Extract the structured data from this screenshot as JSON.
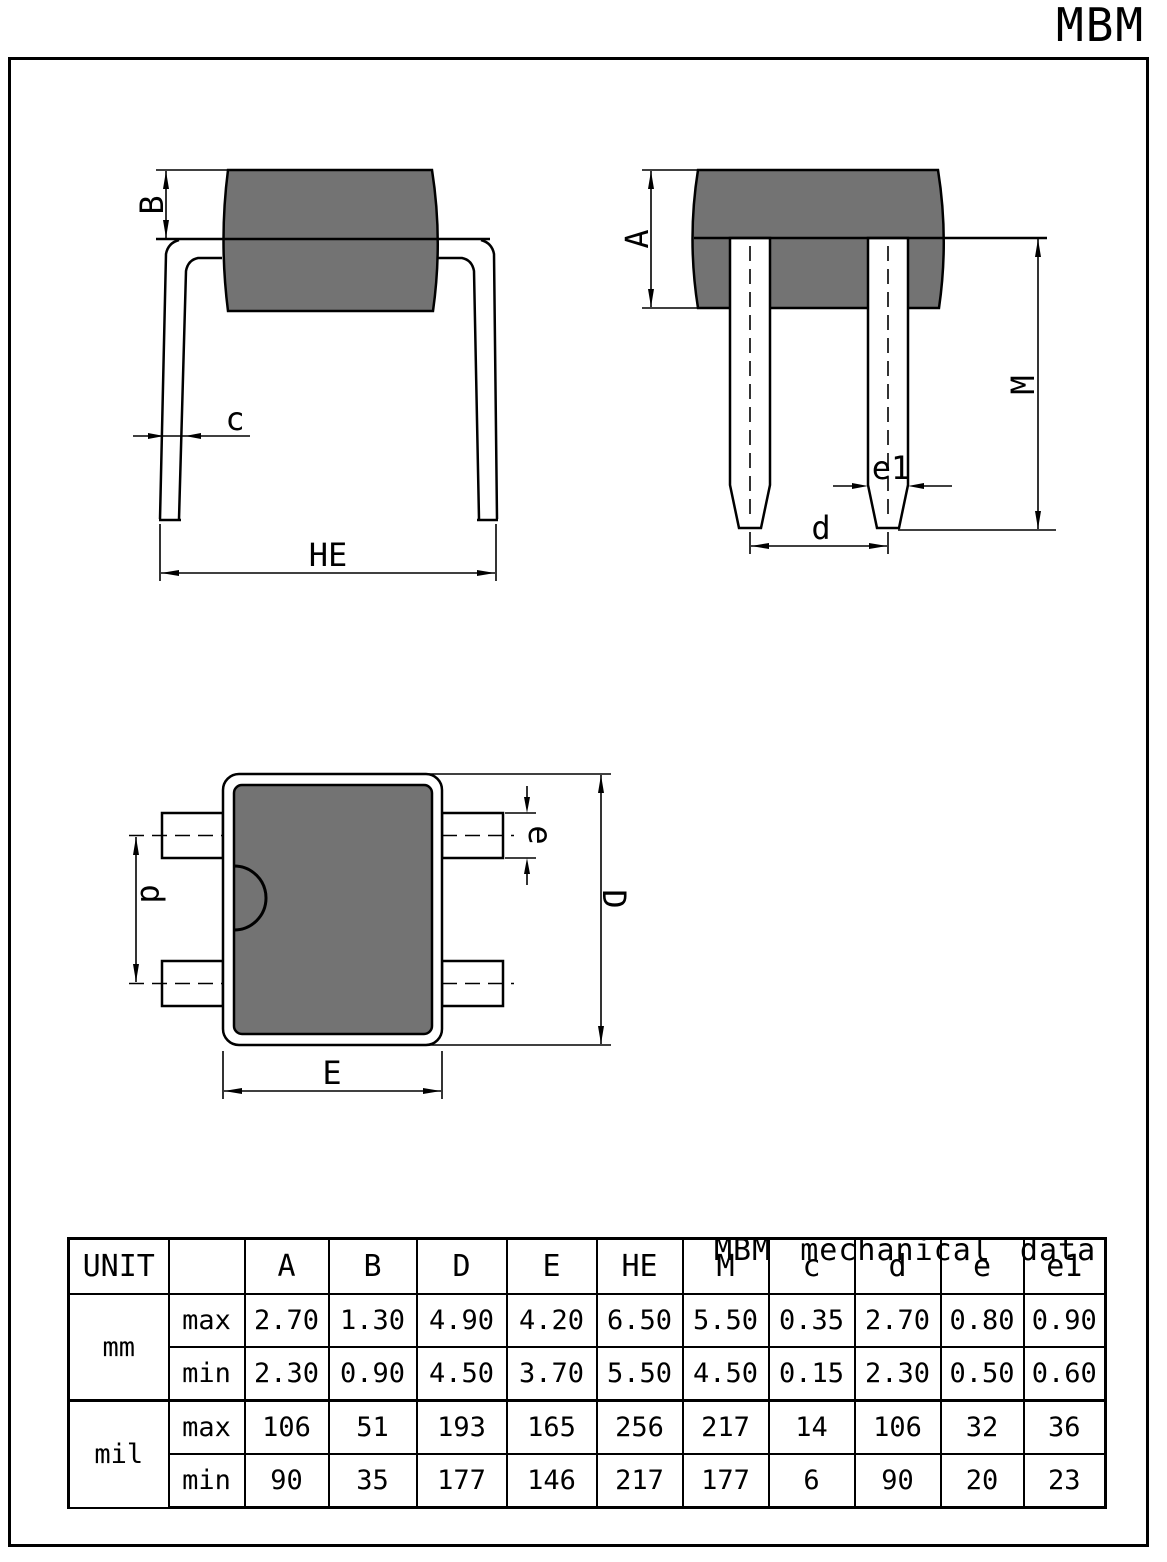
{
  "page": {
    "title": "MBM",
    "bg": "#ffffff",
    "line_color": "#000000",
    "body_gray": "#737373"
  },
  "views": {
    "front": {
      "dims": {
        "B": "B",
        "c": "c",
        "HE": "HE"
      }
    },
    "side": {
      "dims": {
        "A": "A",
        "M": "M",
        "e1": "e1",
        "d": "d"
      }
    },
    "plan": {
      "dims": {
        "d": "d",
        "e": "e",
        "D": "D",
        "E": "E"
      }
    }
  },
  "table": {
    "title": "MBM mechanical data",
    "unit_header": "UNIT",
    "dim_headers": [
      "A",
      "B",
      "D",
      "E",
      "HE",
      "M",
      "c",
      "d",
      "e",
      "e1"
    ],
    "rows": [
      {
        "unit": "mm",
        "bound": "max",
        "values": [
          "2.70",
          "1.30",
          "4.90",
          "4.20",
          "6.50",
          "5.50",
          "0.35",
          "2.70",
          "0.80",
          "0.90"
        ]
      },
      {
        "unit": "",
        "bound": "min",
        "values": [
          "2.30",
          "0.90",
          "4.50",
          "3.70",
          "5.50",
          "4.50",
          "0.15",
          "2.30",
          "0.50",
          "0.60"
        ]
      },
      {
        "unit": "mil",
        "bound": "max",
        "values": [
          "106",
          "51",
          "193",
          "165",
          "256",
          "217",
          "14",
          "106",
          "32",
          "36"
        ]
      },
      {
        "unit": "",
        "bound": "min",
        "values": [
          "90",
          "35",
          "177",
          "146",
          "217",
          "177",
          "6",
          "90",
          "20",
          "23"
        ]
      }
    ]
  }
}
